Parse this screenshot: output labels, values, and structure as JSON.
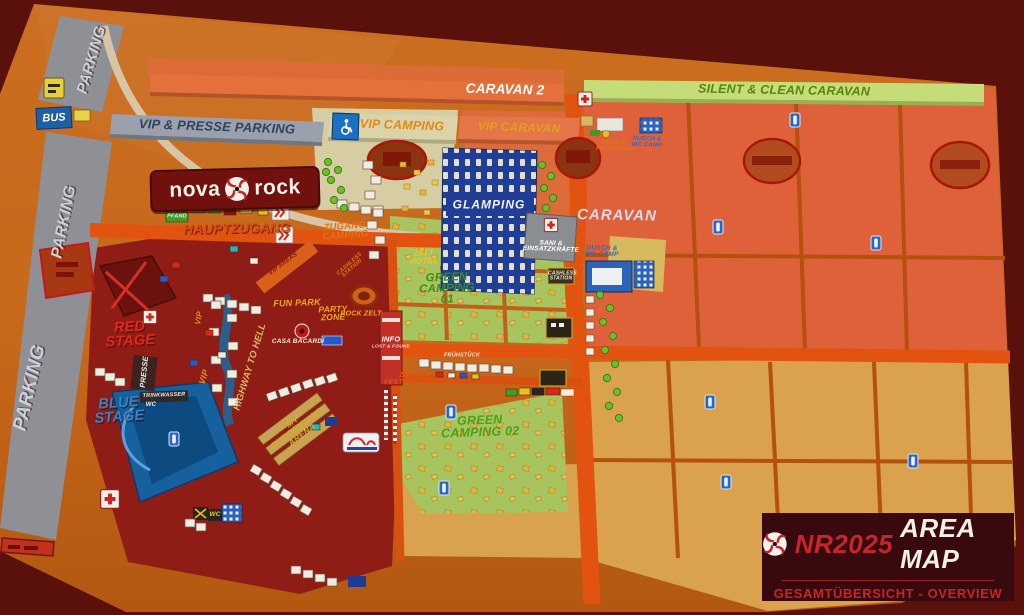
{
  "legend": {
    "code": "NR2025",
    "title": "AREA MAP",
    "subtitle": "GESAMTÜBERSICHT - OVERVIEW"
  },
  "brand": {
    "name_left": "nova",
    "name_right": "rock"
  },
  "zones": {
    "parking": "PARKING",
    "bus": "BUS",
    "vip_presse_parking": "VIP & PRESSE PARKING",
    "caravan_2": "CARAVAN 2",
    "silent_clean_caravan": "SILENT & CLEAN CARAVAN",
    "vip_camping": "VIP CAMPING",
    "vip_caravan": "VIP CARAVAN",
    "caravan": "CARAVAN",
    "glamping": "GLAMPING",
    "zelt_hotel": "ZELT HOTEL",
    "green_camping_01": "GREEN CAMPING 01",
    "green_camping_02": "GREEN CAMPING 02",
    "red_stage": "RED STAGE",
    "blue_stage": "BLUE STAGE",
    "rock_zelt": "ROCK ZELT",
    "fun_park": "FUN PARK",
    "party_zone": "PARTY ZONE",
    "casa_bacardi": "CASA BACARDÍ",
    "my_burgenland_arena": "MY BURGENLAND ARENA",
    "highway_to_hell": "HIGHWAY TO HELL",
    "vip": "VIP",
    "vip_areas": "VIP AREAS",
    "presse": "PRESSE",
    "sani_einsatzkraefte": "SANI & EINSATZKRÄFTE",
    "dusch_wc_camp": "DUSCH & WC CAMP",
    "food_fruehstueck": "FOOD & FRÜHSTÜCK"
  },
  "routes": {
    "hauptzugang": "HAUPTZUGANG",
    "zugang_camping": "ZUGANG CAMPING",
    "zugang_festivalgelaende": "ZUGANG FESTIVALGELÄNDE"
  },
  "poi": {
    "info": "INFO",
    "lost_found": "LOST & FOUND",
    "cashless_station": "CASHLESS STATION",
    "wc": "WC",
    "trinkwasser": "TRINKWASSER",
    "pfand": "PFAND",
    "fruehstueck": "FRÜHSTÜCK"
  },
  "colors": {
    "background_maroon": "#5a110c",
    "map_orange": "#c7681b",
    "festival_red": "#8f1d15",
    "camping_green": "#a7c45f",
    "caravan_salmon": "#df613a",
    "field_tan": "#daa24c",
    "road_orange": "#e25310",
    "glamping_blue": "#203e96",
    "parking_gray": "#8e9096",
    "banner_green": "#c4dd79",
    "legend_red": "#c7252b"
  }
}
